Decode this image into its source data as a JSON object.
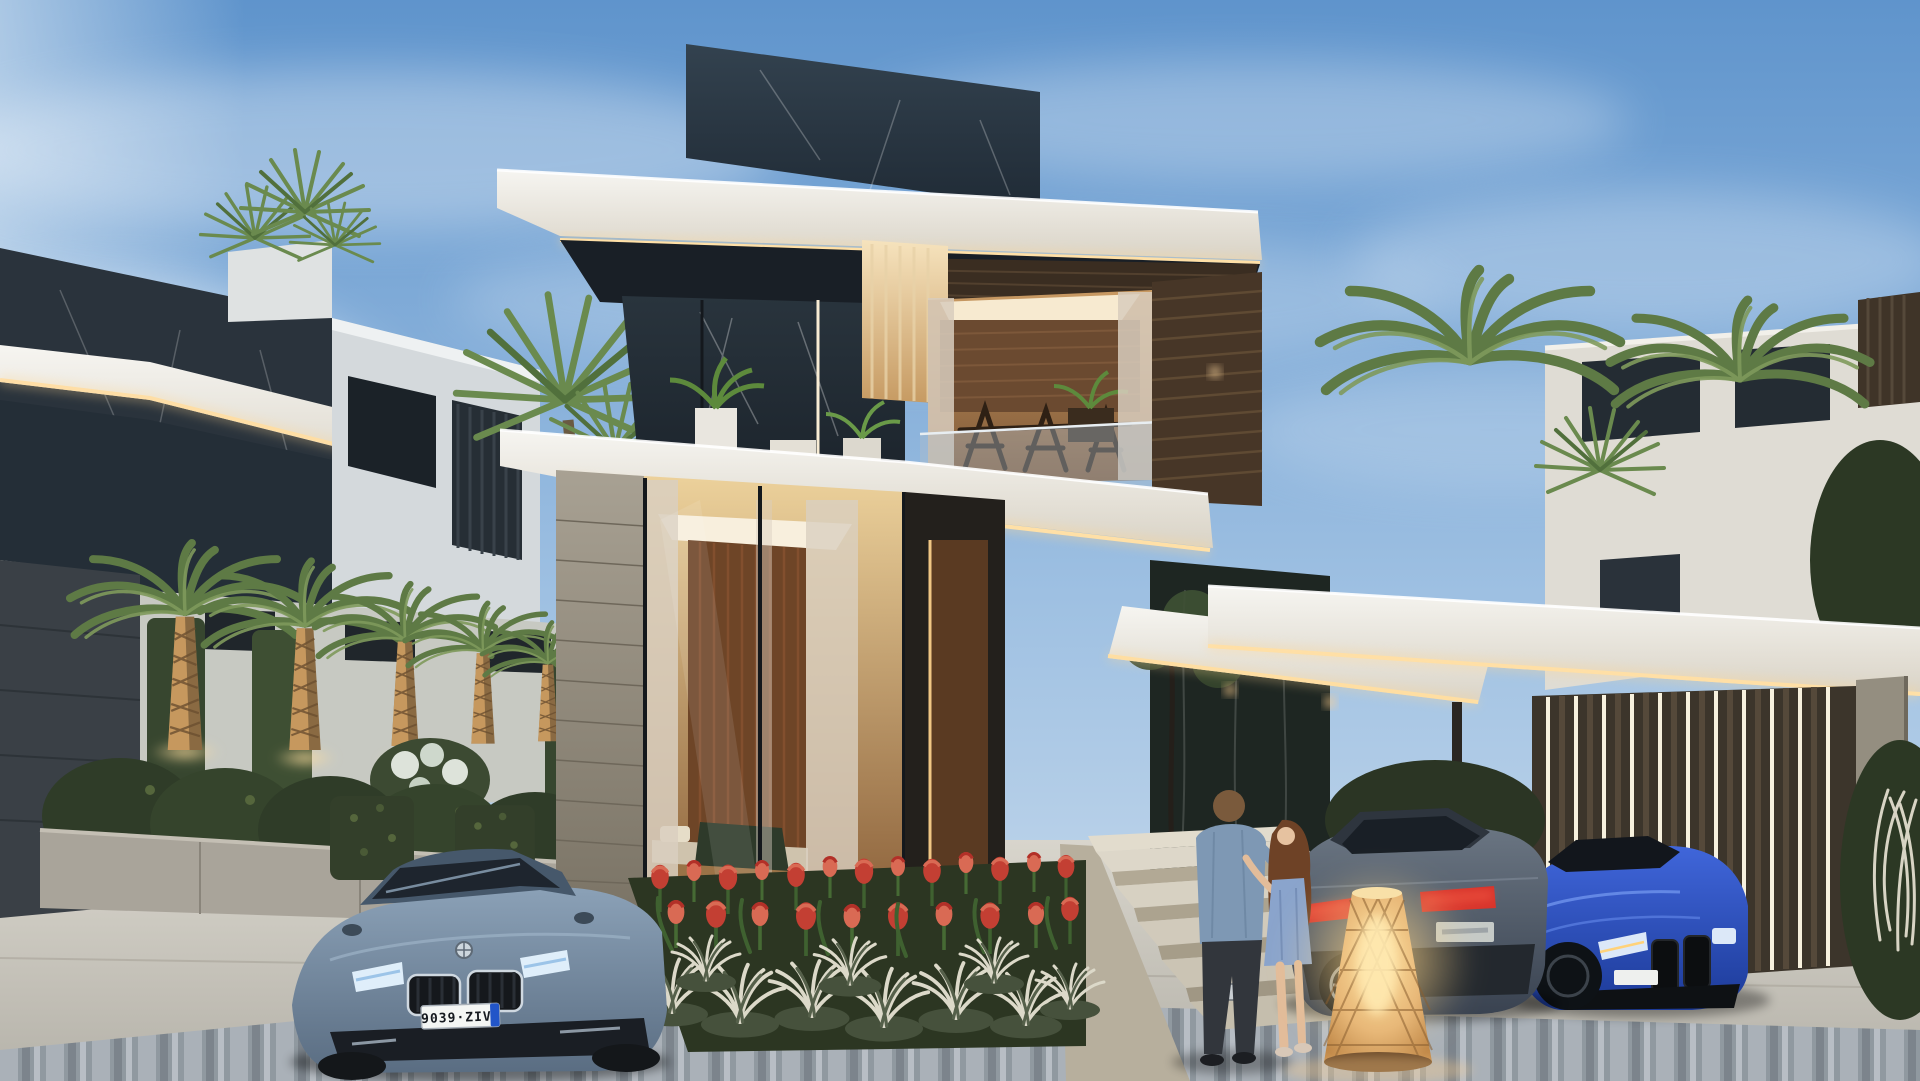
{
  "meta": {
    "title": "Luxury modern villa exterior at dusk",
    "type": "photorealistic architectural rendering",
    "time_of_day": "dusk",
    "canvas": {
      "width": 1920,
      "height": 1081
    }
  },
  "scene": {
    "sky": {
      "top_color": "#5f94cc",
      "horizon_color": "#cfdfee",
      "clouds": "soft hazy streaks"
    },
    "villa": {
      "label": "two-storey modern villa with dark marble glass, white cantilevered slabs and warm LED cove lighting",
      "upper_floor": "dark marble-veined glass, lit dining room with wooden chairs, sheer curtains, balcony plants",
      "ground_floor": "full-height glazing, warm wood feature wall, bedroom interior, stone-clad pier, entry steps",
      "lighting": [
        "LED strip under roof fascia",
        "LED strip under balcony slab",
        "entrance canopy downlights",
        "vertical LED slats at carport"
      ]
    },
    "neighbor_left": {
      "label": "dark glass house with white LED-edged fascias and rooftop palms"
    },
    "neighbor_right": {
      "label": "white house behind carport with palm canopies"
    },
    "vehicles": [
      {
        "id": "front-coupe",
        "label": "gray-blue BMW coupe, front view, lower left",
        "color": "#7d92a8",
        "plate": "9039·ZIV"
      },
      {
        "id": "rear-coupe",
        "label": "dark gray BMW coupe, rear view, center right",
        "color": "#4b5561",
        "plate": ""
      },
      {
        "id": "blue-m4",
        "label": "blue BMW M4 coupe under carport",
        "color": "#2e53c0",
        "plate": ""
      }
    ],
    "people": [
      {
        "id": "man",
        "label": "man in denim shirt and dark trousers, seen from behind"
      },
      {
        "id": "woman",
        "label": "woman with long auburn hair in blue dress and heels"
      }
    ],
    "landscape": {
      "palm_row_left": 5,
      "fan_palm": "tall fan palm by white neighbor house",
      "hedges": "clipped hedge mounds and cubes over low concrete wall",
      "flower_bed": {
        "flowers": "red-orange tulips",
        "underplanting": "white-striped ornamental grass"
      },
      "uplights": "warm uplights on palm trunks"
    },
    "props": {
      "floor_lamp": "glowing woven rattan cone lamp on driveway",
      "pavement": "light concrete walkway with striped gray paver apron"
    }
  },
  "palette": {
    "fascia_white": "#f5f4f0",
    "led_warm": "#ffe3ae",
    "dark_glass": "#222b33",
    "wood_warm": "#6e4527",
    "stone": "#a39c8d",
    "tulip_red": "#c33f33",
    "palm_green": "#5e7a45",
    "driveway": "#cfccc3",
    "paver_gray": "#9099a0"
  }
}
